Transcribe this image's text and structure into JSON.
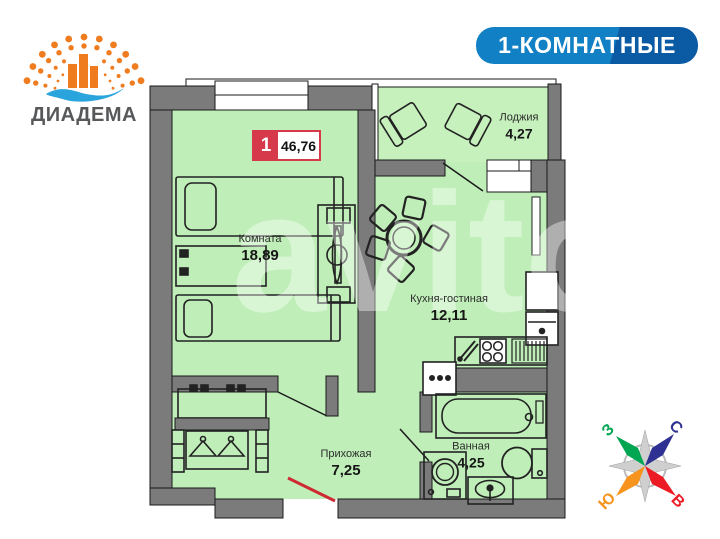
{
  "branding": {
    "name": "ДИАДЕМА"
  },
  "header_badge": {
    "label": "1-КОМНАТНЫЕ"
  },
  "apartment": {
    "rooms_count": "1",
    "total_area": "46,76"
  },
  "rooms": {
    "room": {
      "name": "Комната",
      "area": "18,89"
    },
    "kitchen": {
      "name": "Кухня-гостиная",
      "area": "12,11"
    },
    "loggia": {
      "name": "Лоджия",
      "area": "4,27"
    },
    "hallway": {
      "name": "Прихожая",
      "area": "7,25"
    },
    "bathroom": {
      "name": "Ванная",
      "area": "4,25"
    }
  },
  "compass": {
    "north": "С",
    "south": "Ю",
    "west": "З",
    "east": "В"
  },
  "watermark": "avito",
  "colors": {
    "badge_blue": "#1280c4",
    "badge_blue_dark": "#0a5aa4",
    "accent_red": "#d6394a",
    "entry_door_red": "#cd2a33",
    "room_fill": "#bfeeb8",
    "loggia_fill": "#c6f1bd",
    "wall_gray": "#7b7b7b",
    "logo_orange": "#f07c20",
    "logo_wave_blue": "#29a4dd",
    "logo_text_gray": "#57585a",
    "compass_north": "#2e3192",
    "compass_east": "#ed1c24",
    "compass_south": "#f7941e",
    "compass_west": "#00a651"
  }
}
